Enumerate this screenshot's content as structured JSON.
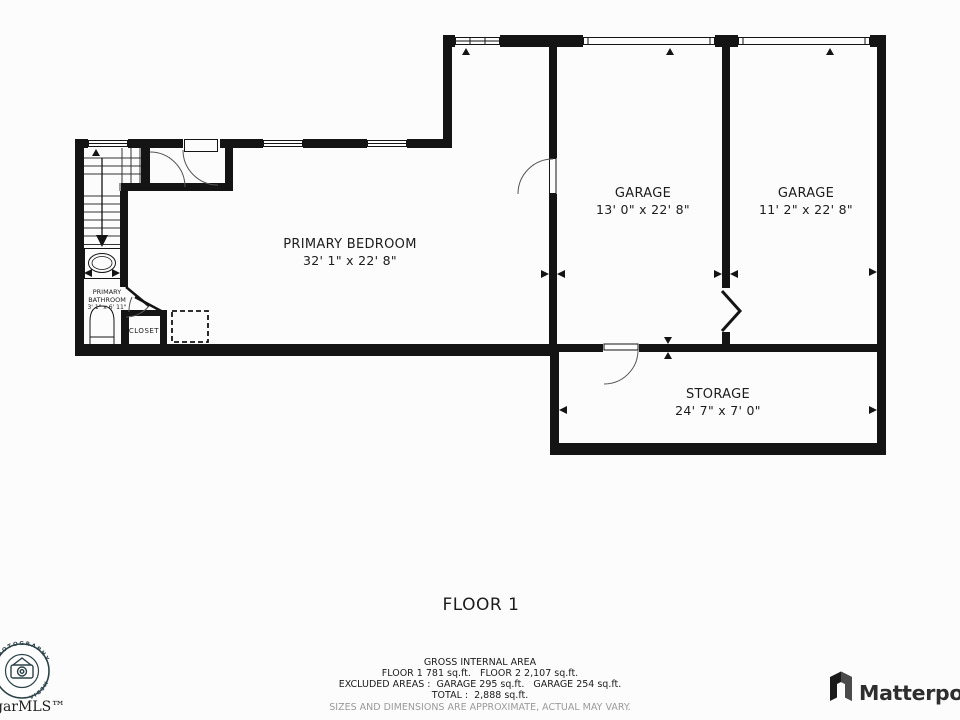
{
  "plan": {
    "rooms": [
      {
        "name": "PRIMARY BEDROOM",
        "dimensions": "32' 1\" x 22' 8\""
      },
      {
        "name": "GARAGE",
        "dimensions": "13' 0\" x 22' 8\""
      },
      {
        "name": "GARAGE",
        "dimensions": "11' 2\" x 22' 8\""
      },
      {
        "name": "STORAGE",
        "dimensions": "24' 7\" x 7' 0\""
      },
      {
        "name": "PRIMARY BATHROOM",
        "dimensions": "3' 1\" x 6' 11\""
      },
      {
        "name": "CLOSET",
        "dimensions": ""
      }
    ]
  },
  "floor_title": "FLOOR 1",
  "footer": {
    "title": "GROSS INTERNAL AREA",
    "floors_line": "FLOOR 1 781 sq.ft.   FLOOR 2 2,107 sq.ft.",
    "excluded_line": "EXCLUDED AREAS :  GARAGE 295 sq.ft.   GARAGE 254 sq.ft.",
    "total_line": "TOTAL :  2,888 sq.ft.",
    "disclaimer": "SIZES AND DIMENSIONS ARE APPROXIMATE, ACTUAL MAY VARY."
  },
  "branding": {
    "mls_wordmark": "garMLS™",
    "badge_arc_top": "PHOTOGRAPHY",
    "badge_arc_side": "MEDIA",
    "matterport_wordmark": "Matterpo"
  },
  "colors": {
    "wall": "#141414",
    "text": "#1c1c1c",
    "muted_text": "#9a9a9a",
    "badge": "#2b4249"
  }
}
